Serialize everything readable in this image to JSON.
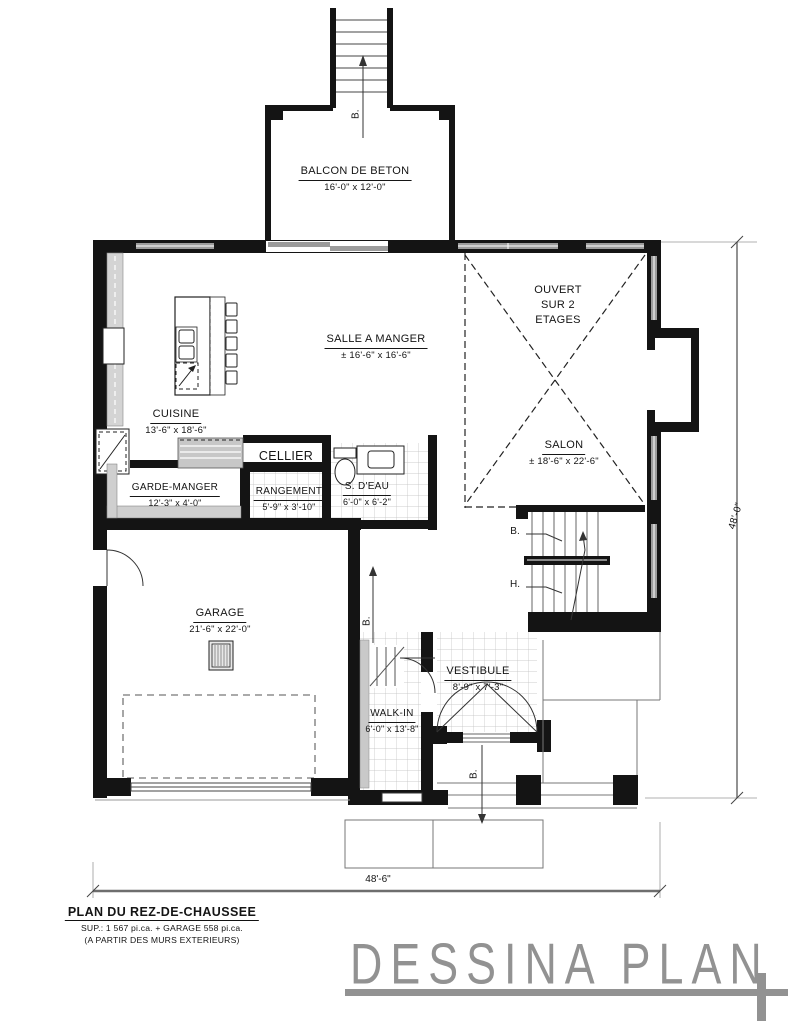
{
  "labels": {
    "down_abbr": "B.",
    "up_abbr": "H."
  },
  "rooms": {
    "balcon": {
      "name": "BALCON DE BETON",
      "size": "16'-0\" x 12'-0\""
    },
    "salle_a_manger": {
      "name": "SALLE A MANGER",
      "size": "± 16'-6\" x 16'-6\""
    },
    "ouvert": {
      "line1": "OUVERT",
      "line2": "SUR 2",
      "line3": "ETAGES"
    },
    "salon": {
      "name": "SALON",
      "size": "± 18'-6\" x 22'-6\""
    },
    "cuisine": {
      "name": "CUISINE",
      "size": "13'-6\" x 18'-6\""
    },
    "cellier": {
      "name": "CELLIER"
    },
    "garde_manger": {
      "name": "GARDE-MANGER",
      "size": "12'-3\" x 4'-0\""
    },
    "rangement": {
      "name": "RANGEMENT",
      "size": "5'-9\" x 3'-10\""
    },
    "s_deau": {
      "name": "S. D'EAU",
      "size": "6'-0\" x 6'-2\""
    },
    "garage": {
      "name": "GARAGE",
      "size": "21'-6\" x 22'-0\""
    },
    "walk_in": {
      "name": "WALK-IN",
      "size": "6'-0\" x 13'-8\""
    },
    "vestibule": {
      "name": "VESTIBULE",
      "size": "8'-9\" x 7'-3\""
    }
  },
  "dimensions": {
    "right": "48'-0\"",
    "bottom": "48'-6\""
  },
  "title_block": {
    "title": "PLAN DU REZ-DE-CHAUSSEE",
    "area": "SUP.: 1 567 pi.ca. + GARAGE 558 pi.ca.",
    "note": "(A PARTIR DES MURS EXTERIEURS)"
  },
  "logo": {
    "text": "DESSINA PLAN"
  },
  "colors": {
    "wall": "#141414",
    "window": "#9c9c9c",
    "logo": "#929292",
    "dimension": "#6e6e6e"
  }
}
